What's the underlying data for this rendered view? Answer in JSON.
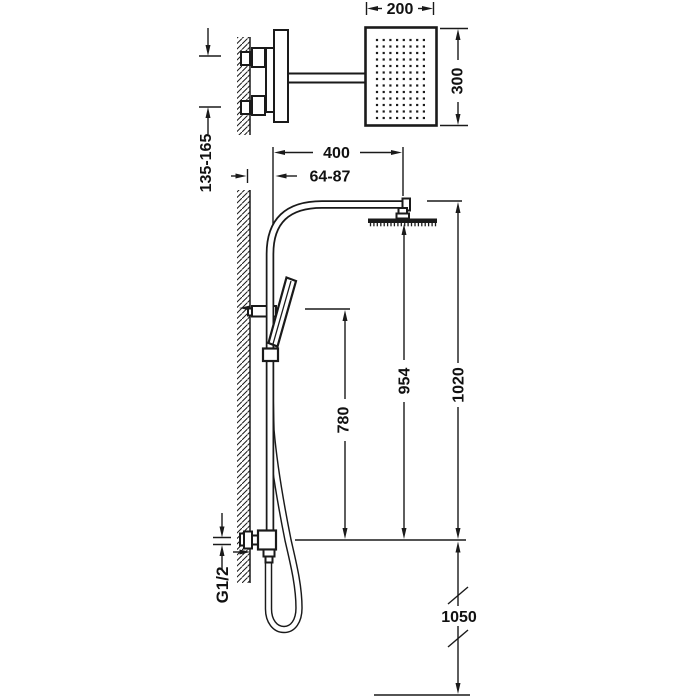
{
  "drawing": {
    "labels": {
      "head_width": "200",
      "head_height": "300",
      "inlet_spacing": "135-165",
      "reach": "400",
      "wall_offset": "64-87",
      "holder_height": "780",
      "head_face_height": "954",
      "arm_height": "1020",
      "outlet_floor_distance": "1050",
      "thread": "G1/2"
    },
    "colors": {
      "line": "#1a1a1a",
      "background": "#ffffff"
    }
  }
}
